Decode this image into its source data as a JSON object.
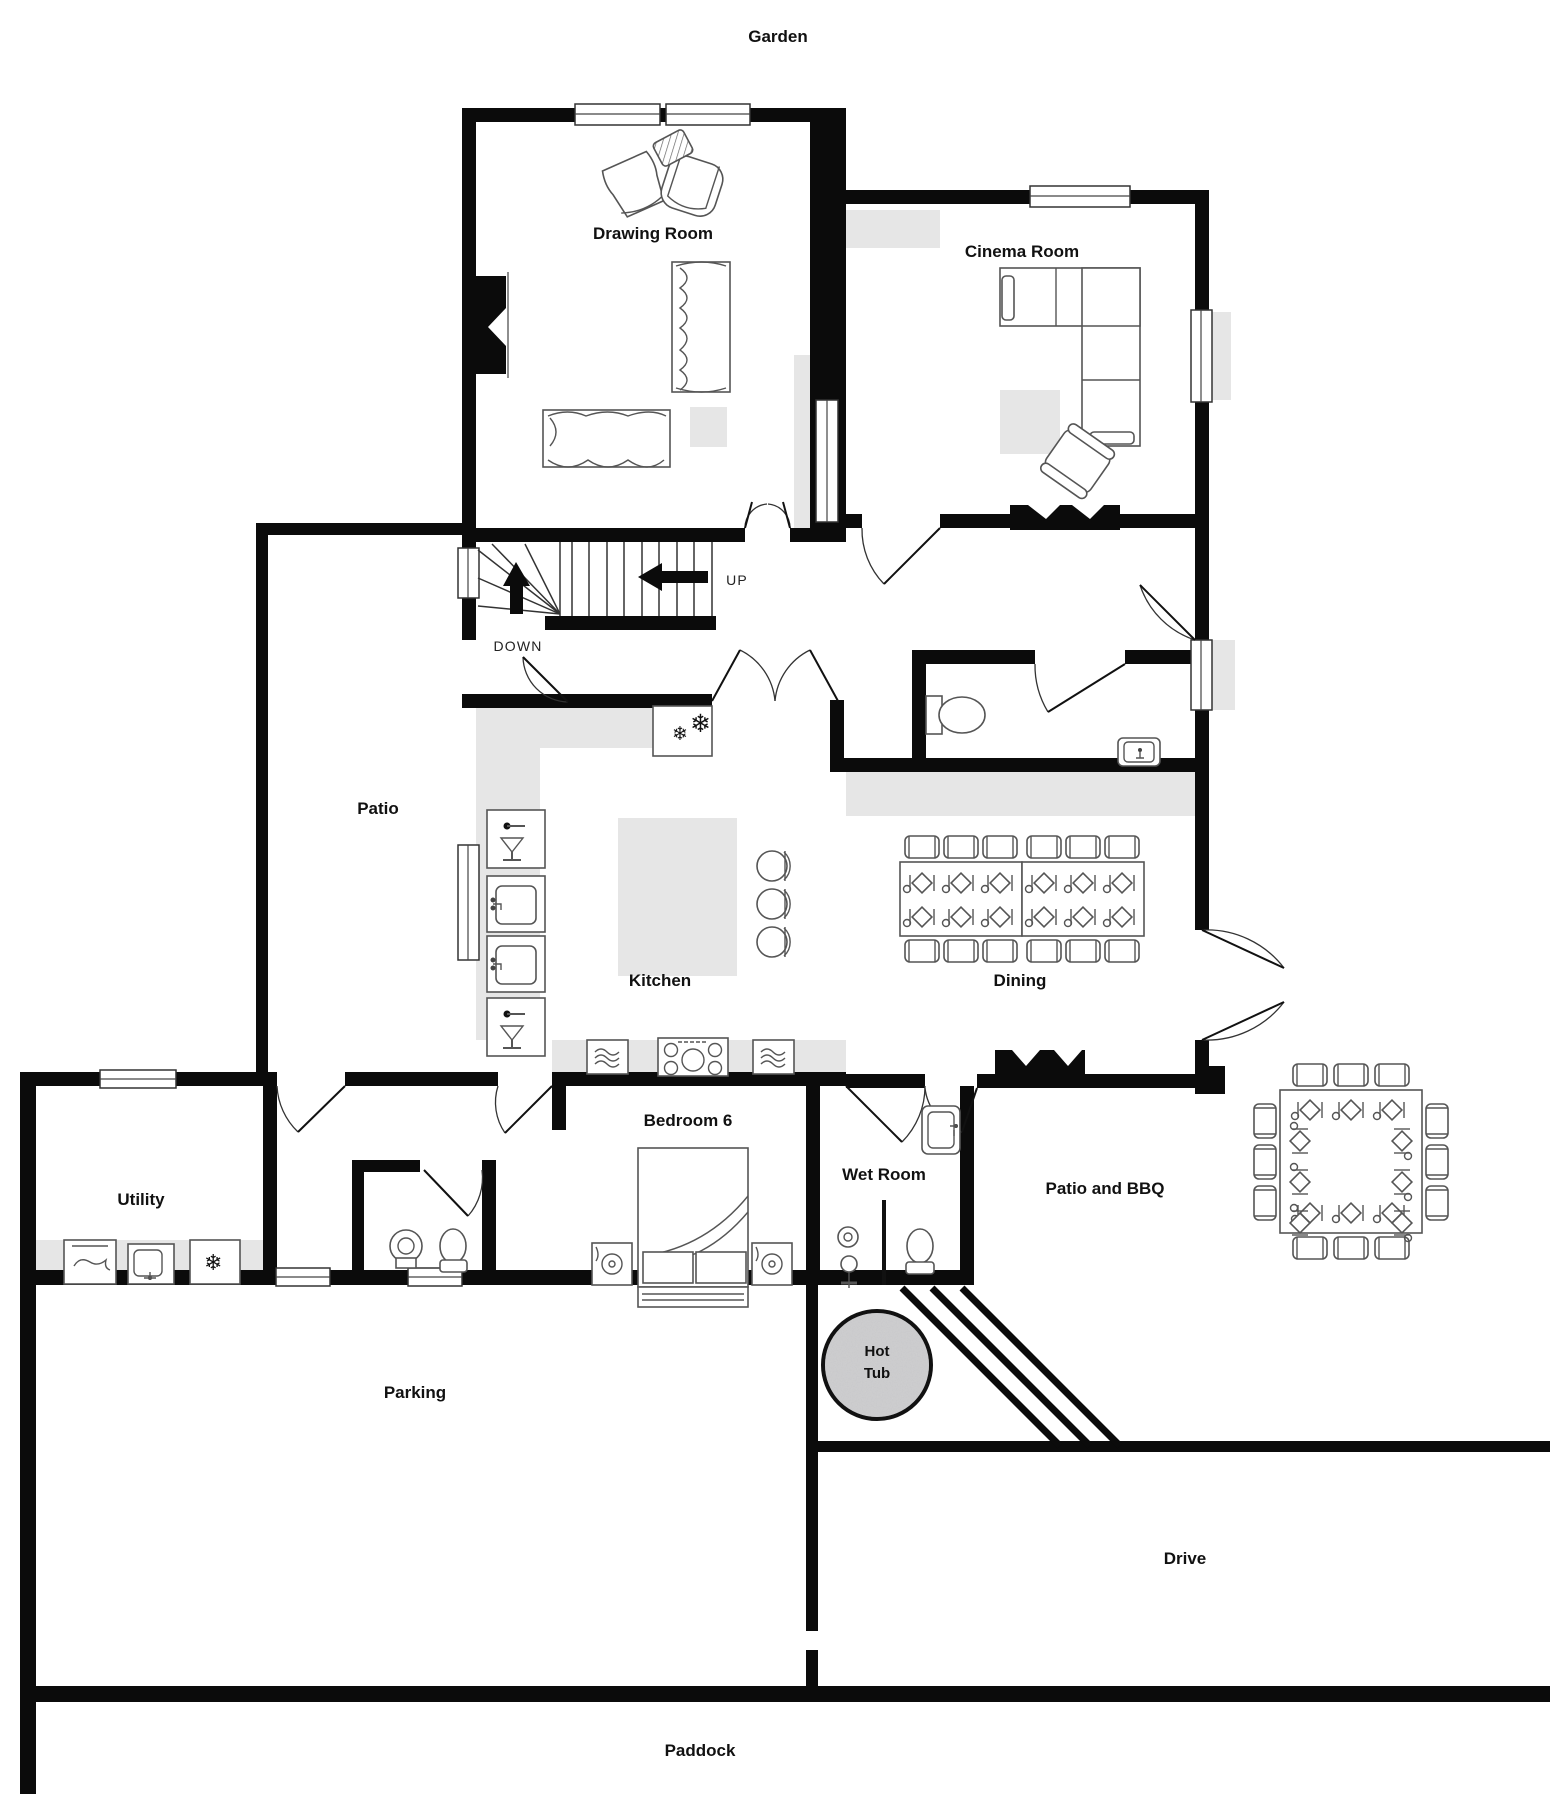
{
  "page": {
    "type": "floor-plan",
    "description": "Ground floor property floor plan"
  },
  "labels": {
    "garden": "Garden",
    "drawing_room": "Drawing Room",
    "cinema_room": "Cinema Room",
    "up": "UP",
    "down": "DOWN",
    "patio": "Patio",
    "kitchen": "Kitchen",
    "dining": "Dining",
    "utility": "Utility",
    "bedroom_6": "Bedroom 6",
    "wet_room": "Wet Room",
    "patio_and_bbq": "Patio and BBQ",
    "hot_tub_line1": "Hot",
    "hot_tub_line2": "Tub",
    "parking": "Parking",
    "drive": "Drive",
    "paddock": "Paddock"
  },
  "icons": {
    "snowflake": "❄"
  },
  "colors": {
    "wall": "#0b0b0b",
    "floor": "#ffffff",
    "shaded_zone": "#e6e6e6",
    "furniture_outline": "#555555",
    "hot_tub_fill": "#d6d6d6"
  },
  "rooms": [
    {
      "name": "Drawing Room"
    },
    {
      "name": "Cinema Room"
    },
    {
      "name": "Kitchen"
    },
    {
      "name": "Dining"
    },
    {
      "name": "Utility"
    },
    {
      "name": "Bedroom 6"
    },
    {
      "name": "Wet Room"
    },
    {
      "name": "Patio"
    },
    {
      "name": "Patio and BBQ"
    },
    {
      "name": "Parking"
    },
    {
      "name": "Drive"
    },
    {
      "name": "Paddock"
    },
    {
      "name": "Garden"
    }
  ]
}
